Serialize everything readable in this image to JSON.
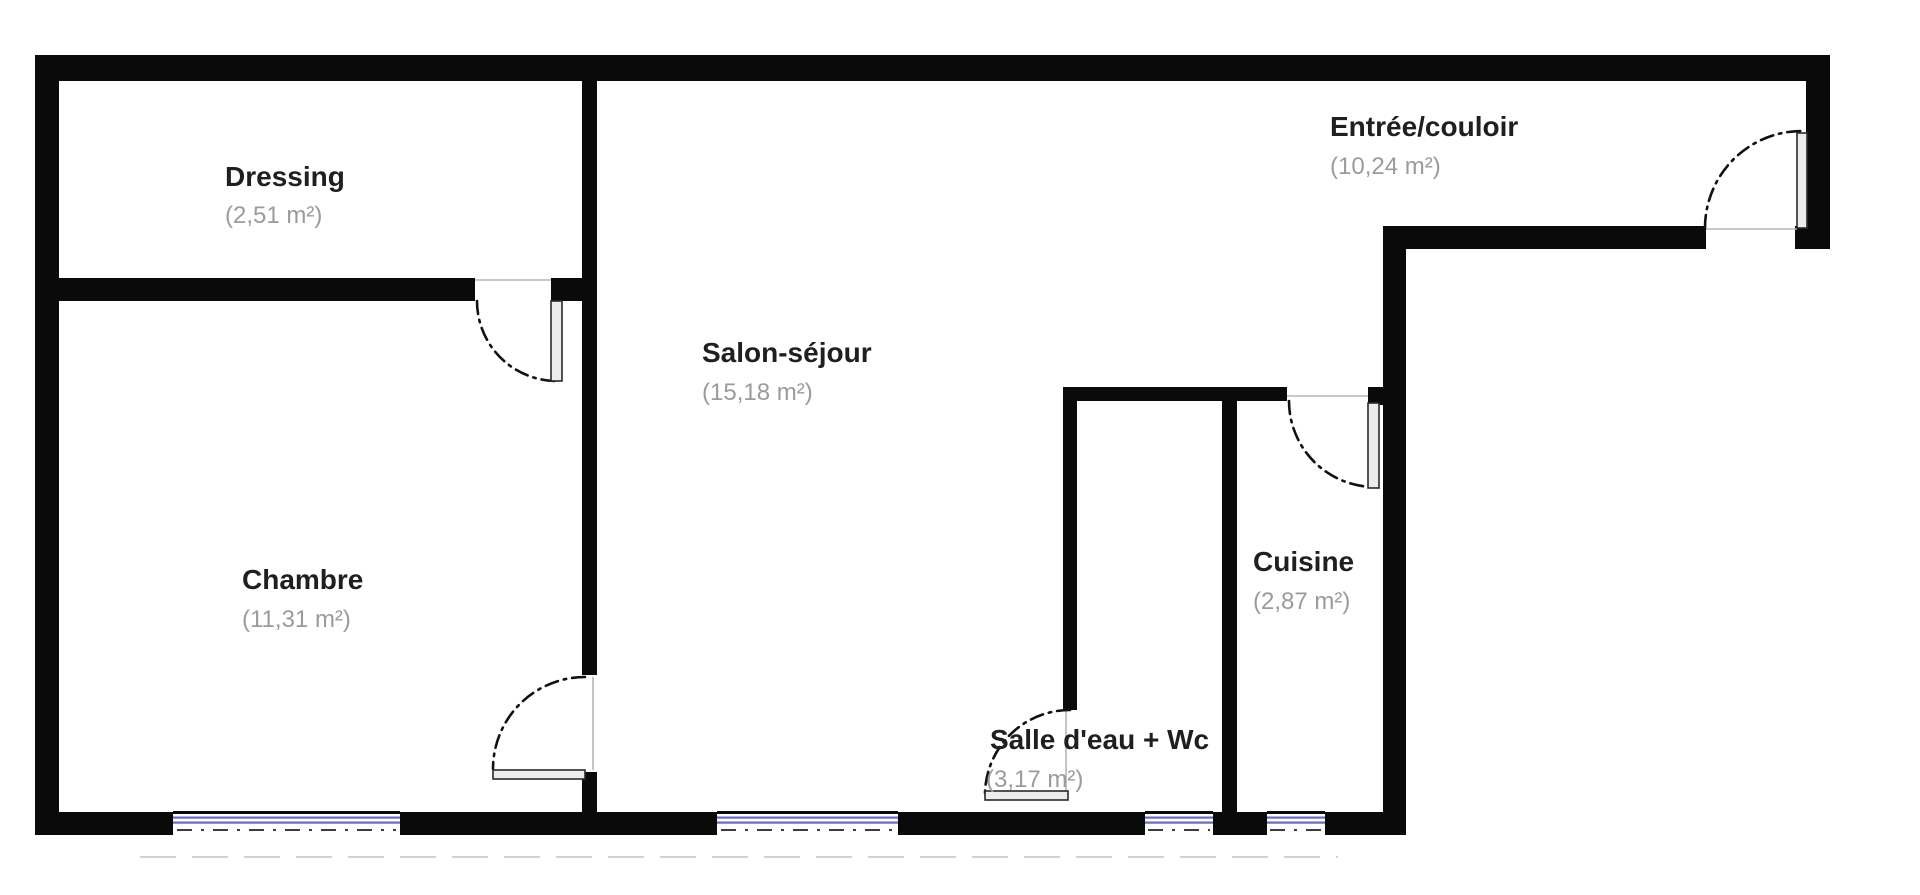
{
  "plan": {
    "rooms": [
      {
        "id": "dressing",
        "name": "Dressing",
        "area": "(2,51 m²)"
      },
      {
        "id": "chambre",
        "name": "Chambre",
        "area": "(11,31 m²)"
      },
      {
        "id": "salon",
        "name": "Salon-séjour",
        "area": "(15,18 m²)"
      },
      {
        "id": "salle-deau",
        "name": "Salle d'eau + Wc",
        "area": "(3,17 m²)"
      },
      {
        "id": "cuisine",
        "name": "Cuisine",
        "area": "(2,87 m²)"
      },
      {
        "id": "entree",
        "name": "Entrée/couloir",
        "area": "(10,24 m²)"
      }
    ],
    "symbols": {
      "doors": [
        "dressing-door",
        "chambre-door",
        "salle-deau-door",
        "cuisine-door",
        "entry-door"
      ],
      "windows": [
        "chambre-window",
        "salon-window",
        "salle-deau-window",
        "cuisine-window"
      ]
    },
    "colors": {
      "background": "#ffffff",
      "wall": "#0a0a0a",
      "room_label": "#1f1f1f",
      "area_label": "#9b9b9b",
      "window_glass": "#6a6ac6",
      "door_leaf_fill": "#ececec",
      "door_leaf_stroke": "#2a2a2a",
      "swing_arc": "#111111",
      "door_closed_line": "#b5b5b5",
      "tick": "#3c3c3c",
      "faint_line": "#d2d2d2"
    }
  }
}
